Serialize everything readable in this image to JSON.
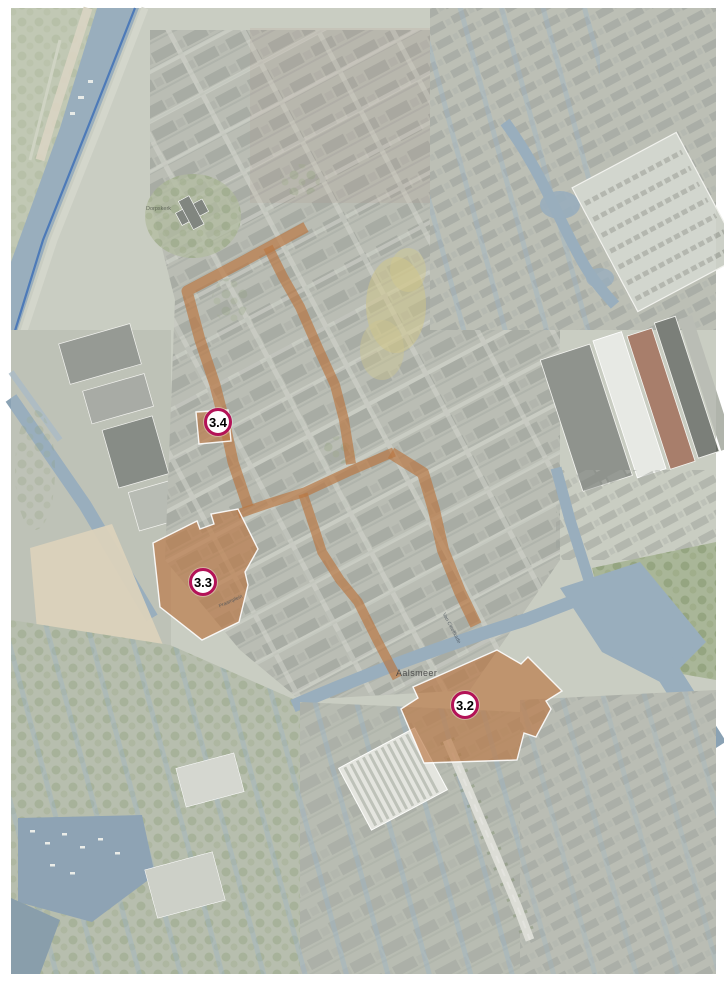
{
  "page": {
    "background": "#ffffff"
  },
  "map": {
    "kind": "aerial photo with development-plan overlay",
    "town_label": "Aalsmeer",
    "markers": [
      {
        "id": "3.4",
        "label": "3.4"
      },
      {
        "id": "3.3",
        "label": "3.3"
      },
      {
        "id": "3.2",
        "label": "3.2"
      }
    ],
    "street_labels": [
      {
        "text": "Dorpskerk"
      },
      {
        "text": "Praamplein"
      },
      {
        "text": "Van Cleeffkade"
      }
    ],
    "colors": {
      "highlight_area": "#b06327",
      "marker_ring": "#b31257",
      "marker_fill": "#ffffff",
      "marker_text": "#000000",
      "boundary_line": "#2e64ae",
      "water": "#8aa2b4",
      "land_base": "#c2c6b9"
    }
  }
}
